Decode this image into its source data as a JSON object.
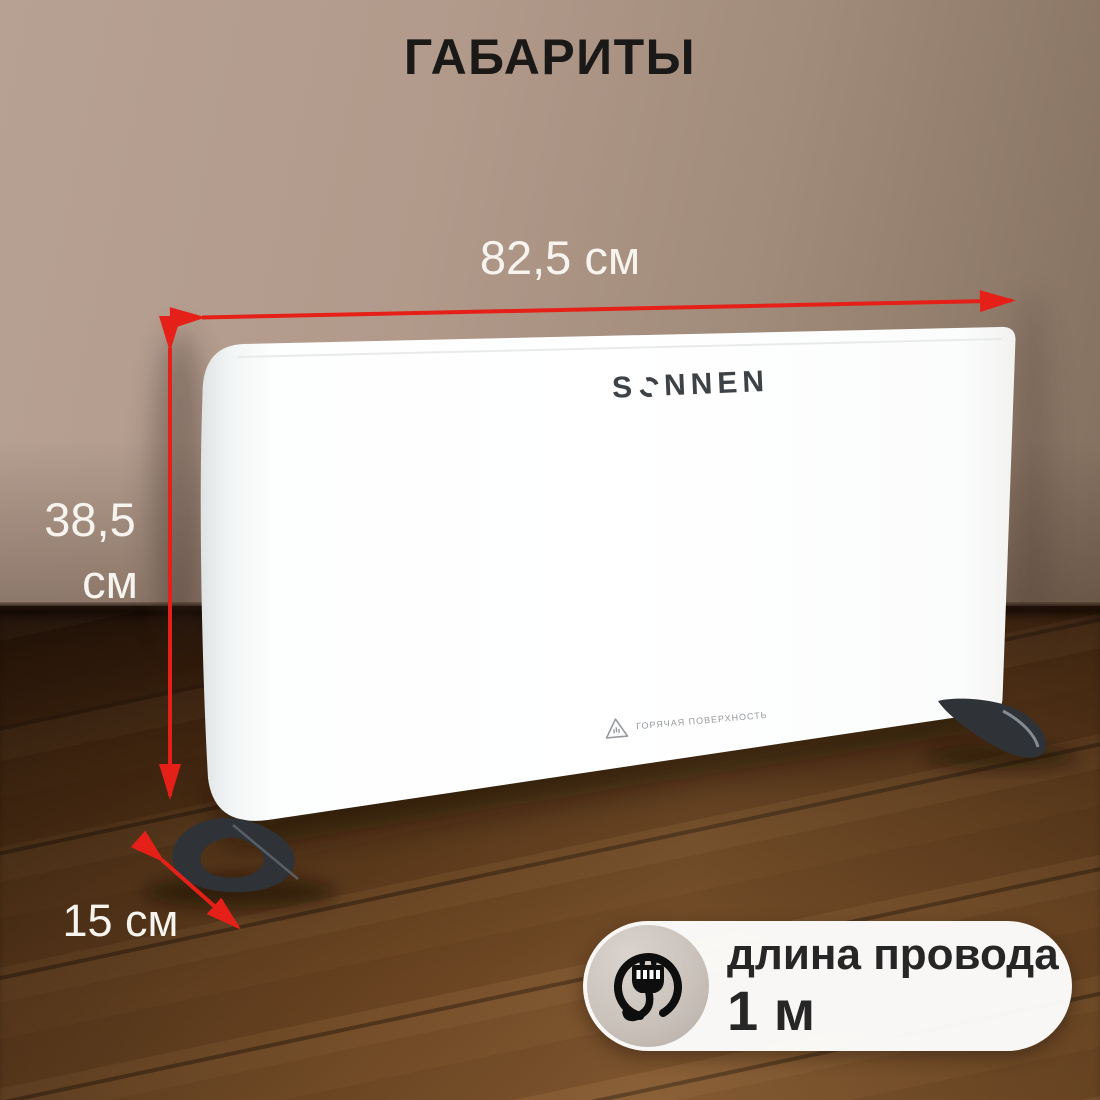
{
  "title": "ГАБАРИТЫ",
  "product": {
    "brand": "SONNEN",
    "brand_parts": {
      "s": "S",
      "rest": "NNEN"
    },
    "warning_label": "ГОРЯЧАЯ ПОВЕРХНОСТЬ"
  },
  "dimensions": {
    "width_label": "82,5 см",
    "height_value": "38,5",
    "height_unit": "см",
    "depth_label": "15 см"
  },
  "badge": {
    "line1": "длина провода",
    "line2": "1 м"
  },
  "colors": {
    "arrow_red": "#e52018",
    "wall": "#b29a8b",
    "floor": "#64401e",
    "heater_white": "#ffffff",
    "foot_dark": "#2f3338",
    "title_text": "#1b1917",
    "dimension_text": "#f7f4f0",
    "badge_text": "#262626",
    "warning_gray": "#96999c"
  },
  "icons": {
    "plug": "plug-icon",
    "warning_triangle": "warning-triangle-icon",
    "width_arrow": "width-arrow",
    "height_arrow": "height-arrow",
    "depth_arrow": "depth-arrow"
  }
}
